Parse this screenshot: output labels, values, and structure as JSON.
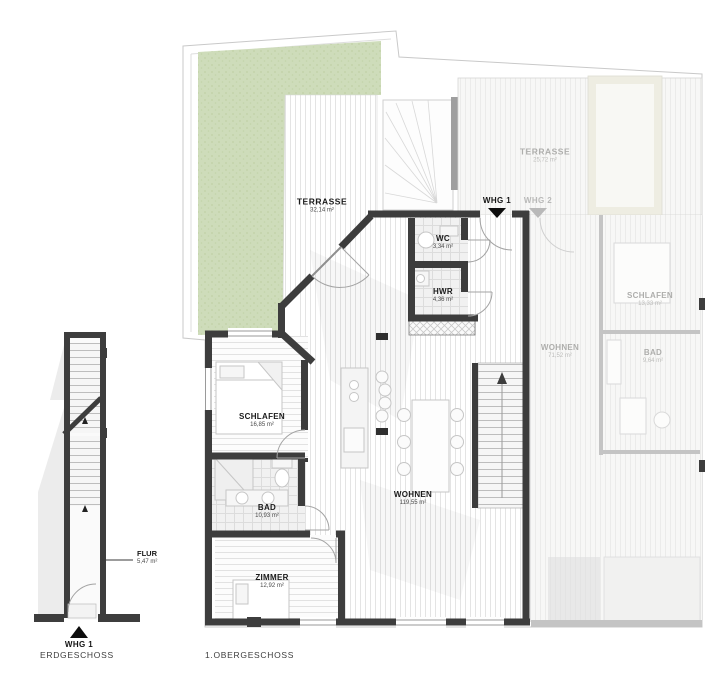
{
  "captions": {
    "erdgeschoss": "ERDGESCHOSS",
    "obergeschoss": "1.OBERGESCHOSS"
  },
  "erdgeschoss": {
    "entrance": {
      "label": "WHG 1"
    },
    "rooms": {
      "flur": {
        "name": "FLUR",
        "area": "5,47 m²"
      }
    }
  },
  "obergeschoss": {
    "whg1": {
      "entrance": {
        "label": "WHG 1"
      },
      "rooms": {
        "terrasse": {
          "name": "TERRASSE",
          "area": "32,14 m²"
        },
        "wc": {
          "name": "WC",
          "area": "3,34 m²"
        },
        "hwr": {
          "name": "HWR",
          "area": "4,36 m²"
        },
        "schlafen": {
          "name": "SCHLAFEN",
          "area": "16,85 m²"
        },
        "bad": {
          "name": "BAD",
          "area": "10,93 m²"
        },
        "zimmer": {
          "name": "ZIMMER",
          "area": "12,92 m²"
        },
        "wohnen": {
          "name": "WOHNEN",
          "area": "119,55 m²"
        }
      }
    },
    "whg2": {
      "entrance": {
        "label": "WHG 2"
      },
      "rooms": {
        "terrasse": {
          "name": "TERRASSE",
          "area": "25,72 m²"
        },
        "schlafen": {
          "name": "SCHLAFEN",
          "area": "13,33 m²"
        },
        "wohnen": {
          "name": "WOHNEN",
          "area": "71,52 m²"
        },
        "bad": {
          "name": "BAD",
          "area": "9,64 m²"
        }
      }
    }
  },
  "colors": {
    "wall": "#3d3d3d",
    "wall_faded": "#c4c4c4",
    "lawn": "#cedcba",
    "label": "#1a1a1a",
    "label_faded": "#aeaeac"
  }
}
